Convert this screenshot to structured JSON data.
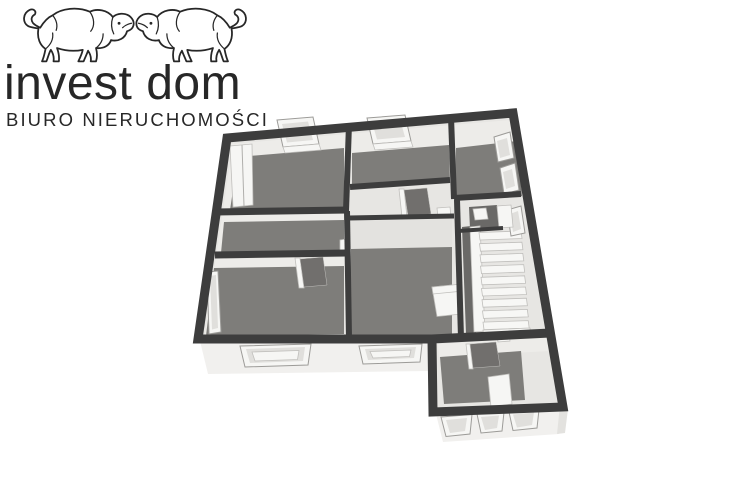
{
  "logo": {
    "brand": "invest dom",
    "subtitle": "BIURO NIERUCHOMOŚCI"
  },
  "floorplan": {
    "alt": "3D floor plan"
  },
  "theme": {
    "background": "#ffffff",
    "logo_ink": "#272727",
    "wall_dark": "#3d3d3d",
    "wall_face": "#edece9",
    "wall_face_dim": "#e3e2df",
    "floor_light": "#e7e6e3",
    "floor_carpet": "#7e7d7a",
    "floor_carpet_dim": "#6a6967",
    "facade_white": "#f1f0ee",
    "object_white": "#f6f6f4",
    "pane_gray": "#e0dfdc",
    "frame_gray": "#c0bfbc",
    "frame_line": "#9c9b98",
    "door_dark": "#716f6d",
    "stair_tread": "#f7f7f5"
  }
}
